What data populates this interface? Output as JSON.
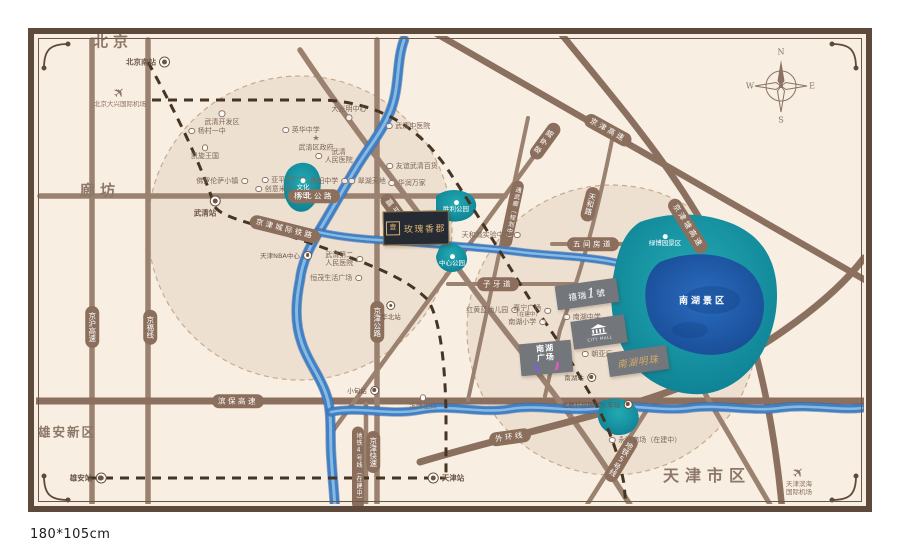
{
  "caption": "180*105cm",
  "compass": {
    "n": "N",
    "e": "E",
    "s": "S",
    "w": "W"
  },
  "colors": {
    "frame": "#5e4a3c",
    "mapBg": "#f8eee1",
    "road": "#9a8170",
    "highway": "#8b7060",
    "river": "#4180c4",
    "lakeTeal": "#0e8396",
    "lakeBlue": "#1d5cb0",
    "rail": "#463524",
    "pill": "#8b6f5c",
    "gold": "#d8b273"
  },
  "regions": [
    {
      "t": "北京",
      "x": 113,
      "y": 41,
      "cls": "lg"
    },
    {
      "t": "廊坊",
      "x": 100,
      "y": 190,
      "cls": "lg"
    },
    {
      "t": "雄安新区",
      "x": 67,
      "y": 431,
      "cls": "md"
    },
    {
      "t": "天津市区",
      "x": 707,
      "y": 474,
      "cls": "xl"
    }
  ],
  "stations": [
    {
      "t": "北京南站",
      "x": 148,
      "y": 62,
      "side": "l"
    },
    {
      "t": "武清站",
      "x": 215,
      "y": 207,
      "side": "bl"
    },
    {
      "t": "雄安站",
      "x": 88,
      "y": 478,
      "side": "l"
    },
    {
      "t": "天津站",
      "x": 446,
      "y": 478,
      "side": "r"
    },
    {
      "t": "南湖站",
      "x": 580,
      "y": 377,
      "side": "l",
      "small": true
    },
    {
      "t": "小甸站",
      "x": 363,
      "y": 390,
      "side": "l",
      "small": true
    },
    {
      "t": "华北站",
      "x": 391,
      "y": 311,
      "side": "b",
      "small": true
    },
    {
      "t": "北辰科技园区火车站",
      "x": 597,
      "y": 404,
      "side": "l",
      "small": true
    },
    {
      "t": "天津NBA中心",
      "x": 286,
      "y": 255,
      "side": "l",
      "small": true
    }
  ],
  "airports": [
    {
      "lines": [
        "北京大兴国际机场"
      ],
      "x": 120,
      "y": 86
    },
    {
      "lines": [
        "天津滨海",
        "国际机场"
      ],
      "x": 799,
      "y": 466
    }
  ],
  "roadPills": [
    {
      "t": "杨北公路",
      "x": 314,
      "y": 196
    },
    {
      "t": "滨保高速",
      "x": 238,
      "y": 401
    },
    {
      "t": "外环线",
      "x": 510,
      "y": 437,
      "rot": -8
    },
    {
      "t": "子牙道",
      "x": 498,
      "y": 284
    },
    {
      "t": "五间房道",
      "x": 593,
      "y": 244
    },
    {
      "t": "京津城际铁路",
      "x": 285,
      "y": 229,
      "rot": 14
    },
    {
      "t": "京津高速",
      "x": 608,
      "y": 130,
      "rot": 29
    },
    {
      "t": "京津塘高速",
      "x": 688,
      "y": 226,
      "rot": 58
    },
    {
      "t": "翠亨路",
      "x": 545,
      "y": 141,
      "rot": -54
    },
    {
      "t": "嘉平道",
      "x": 396,
      "y": 212,
      "rot": 54
    },
    {
      "t": "京沪高速",
      "x": 92,
      "y": 327,
      "vert": true
    },
    {
      "t": "京福线",
      "x": 150,
      "y": 327,
      "vert": true
    },
    {
      "t": "京津公路",
      "x": 377,
      "y": 322,
      "vert": true
    },
    {
      "t": "京津快速",
      "x": 373,
      "y": 452,
      "vert": true
    },
    {
      "t": "地铁4号线（在建中）",
      "x": 358,
      "y": 468,
      "vert": true,
      "small": true
    },
    {
      "t": "天和路",
      "x": 590,
      "y": 204,
      "vert": true,
      "rot": 14
    },
    {
      "t": "通武廊（规划中）",
      "x": 512,
      "y": 214,
      "vert": true,
      "rot": 12,
      "small": true
    },
    {
      "t": "地铁5号线",
      "x": 621,
      "y": 459,
      "vert": true,
      "rot": 31
    }
  ],
  "pois": [
    {
      "t": "武清开发区",
      "x": 222,
      "y": 118,
      "dot": "t"
    },
    {
      "t": "杨村一中",
      "x": 207,
      "y": 131,
      "dot": "l"
    },
    {
      "t": "凯旋王国",
      "x": 205,
      "y": 152,
      "dot": "t"
    },
    {
      "t": "佛罗伦萨小镇",
      "x": 222,
      "y": 181,
      "dot": "r"
    },
    {
      "t": "亚平宁广场",
      "x": 284,
      "y": 180,
      "dot": "l"
    },
    {
      "t": "创意米兰",
      "x": 274,
      "y": 189,
      "dot": "l"
    },
    {
      "t": "英华中学",
      "x": 301,
      "y": 130,
      "dot": "l"
    },
    {
      "t": "武清区政府",
      "x": 316,
      "y": 143,
      "star": true
    },
    {
      "lines": [
        "武清",
        "人民医院"
      ],
      "x": 334,
      "y": 156,
      "dot": "l"
    },
    {
      "t": "雍阳中学",
      "x": 329,
      "y": 181,
      "dot": "r"
    },
    {
      "t": "翠湖天地",
      "x": 367,
      "y": 181,
      "dot": "l"
    },
    {
      "t": "大光明中心",
      "x": 349,
      "y": 113,
      "dot": "b"
    },
    {
      "t": "武清中医院",
      "x": 408,
      "y": 126,
      "dot": "l"
    },
    {
      "t": "友谊武清百货",
      "x": 412,
      "y": 166,
      "dot": "l"
    },
    {
      "t": "华润万家",
      "x": 407,
      "y": 183,
      "dot": "l"
    },
    {
      "lines": [
        "武清第二",
        "人民医院"
      ],
      "x": 344,
      "y": 259,
      "dot": "r"
    },
    {
      "t": "恒茂生活广场",
      "x": 336,
      "y": 278,
      "dot": "r"
    },
    {
      "t": "天和城实验中学",
      "x": 491,
      "y": 235,
      "dot": "r"
    },
    {
      "t": "红黄蓝幼儿园",
      "x": 492,
      "y": 310,
      "dot": "r"
    },
    {
      "t": "嘉宁广场",
      "sub": "（在建中）",
      "x": 532,
      "y": 311,
      "dot": "r"
    },
    {
      "t": "南湖小学",
      "x": 527,
      "y": 322,
      "dot": "r"
    },
    {
      "t": "南湖中学",
      "x": 582,
      "y": 317,
      "dot": "l"
    },
    {
      "t": "朝亚汇",
      "x": 597,
      "y": 354,
      "dot": "l"
    },
    {
      "t": "永旺商场（在建中）",
      "x": 645,
      "y": 440,
      "dot": "l"
    },
    {
      "t": "滨保出口",
      "x": 423,
      "y": 402,
      "dot": "t",
      "white": true
    }
  ],
  "parks": [
    {
      "lines": [
        "文化",
        "公园"
      ],
      "x": 303,
      "y": 189,
      "icon": true
    },
    {
      "lines": [
        "胜利公园"
      ],
      "x": 456,
      "y": 207,
      "icon": true
    },
    {
      "lines": [
        "中心公园"
      ],
      "x": 452,
      "y": 261,
      "icon": true
    },
    {
      "lines": [
        "绿博园景区"
      ],
      "x": 665,
      "y": 241,
      "icon": true
    },
    {
      "lines": [
        "南湖景区"
      ],
      "x": 703,
      "y": 302,
      "big": true
    }
  ],
  "plaques": {
    "rose": {
      "logo": "壹",
      "name": "玫瑰香郡"
    },
    "xirui": {
      "pre": "禧瑞",
      "num": "1",
      "post": "號"
    },
    "mall": {
      "caption": "CITY MALL"
    },
    "plaza": {
      "line1": "南湖",
      "line2": "广场"
    },
    "pearl": {
      "name": "南湖明珠"
    }
  }
}
